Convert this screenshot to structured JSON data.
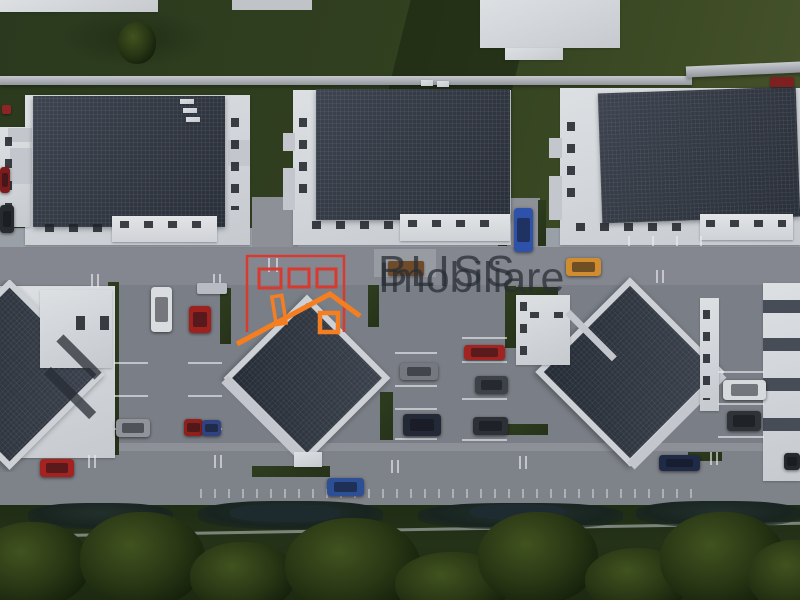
{
  "scene": {
    "type": "aerial-3d-architectural-render",
    "subject": "residential complex with parking lots, three gabled apartment buildings along a street and two diamond-roof buildings below",
    "watermark": {
      "line1": "BLISS",
      "line2": "Imobiliare"
    },
    "logo": {
      "name": "bliss-imobiliare-logo"
    },
    "palette": {
      "wall": "#d2d5da",
      "roof": "#343b45",
      "road": "#84878f",
      "parking": "#7a7e86",
      "sidewalk": "#9aa0a7",
      "lawn": "#2e3c1f",
      "lawn_light": "#46532c",
      "green_bottom": "#223016",
      "hedge": "#182420",
      "logo_red": "#d93a2f",
      "logo_orange": "#f57e20",
      "watermark": "rgba(40,45,52,0.75)",
      "car_glass": "rgba(15,18,24,0.5)"
    },
    "cars": [
      {
        "name": "white-sedan",
        "x": 151,
        "y": 287,
        "w": 21,
        "h": 45,
        "color": "#dadde0"
      },
      {
        "name": "red-hatchback",
        "x": 189,
        "y": 306,
        "w": 22,
        "h": 27,
        "color": "#9e211e"
      },
      {
        "name": "blue-sedan",
        "x": 514,
        "y": 208,
        "w": 19,
        "h": 44,
        "color": "#2e52aa"
      },
      {
        "name": "orange-car",
        "x": 566,
        "y": 258,
        "w": 35,
        "h": 18,
        "color": "#cf8d2f"
      },
      {
        "name": "gray-car",
        "x": 400,
        "y": 363,
        "w": 38,
        "h": 17,
        "color": "#75787f"
      },
      {
        "name": "red-car-middle",
        "x": 464,
        "y": 345,
        "w": 41,
        "h": 15,
        "color": "#a22421"
      },
      {
        "name": "graphite-car",
        "x": 475,
        "y": 376,
        "w": 33,
        "h": 18,
        "color": "#3d4148"
      },
      {
        "name": "dark-car-middle",
        "x": 473,
        "y": 417,
        "w": 35,
        "h": 18,
        "color": "#2d3036"
      },
      {
        "name": "navy-car",
        "x": 403,
        "y": 414,
        "w": 38,
        "h": 22,
        "color": "#242938"
      },
      {
        "name": "white-van",
        "x": 723,
        "y": 380,
        "w": 43,
        "h": 20,
        "color": "#d7dadd"
      },
      {
        "name": "dark-car-right",
        "x": 727,
        "y": 411,
        "w": 34,
        "h": 20,
        "color": "#2f3237"
      },
      {
        "name": "silver-car",
        "x": 116,
        "y": 419,
        "w": 34,
        "h": 18,
        "color": "#90939a"
      },
      {
        "name": "red-car-pair",
        "x": 184,
        "y": 419,
        "w": 19,
        "h": 17,
        "color": "#8f201d"
      },
      {
        "name": "blue-car-pair",
        "x": 202,
        "y": 420,
        "w": 19,
        "h": 16,
        "color": "#30427f"
      },
      {
        "name": "red-car-road",
        "x": 40,
        "y": 459,
        "w": 34,
        "h": 18,
        "color": "#a42320"
      },
      {
        "name": "blue-car-road",
        "x": 327,
        "y": 478,
        "w": 37,
        "h": 18,
        "color": "#2c4f95"
      },
      {
        "name": "navy-car-road",
        "x": 659,
        "y": 455,
        "w": 41,
        "h": 16,
        "color": "#1f2b46"
      },
      {
        "name": "dark-car-corner",
        "x": 784,
        "y": 453,
        "w": 16,
        "h": 17,
        "color": "#25282d"
      },
      {
        "name": "red-car-edge",
        "x": 0,
        "y": 167,
        "w": 10,
        "h": 26,
        "color": "#7d1c1c"
      },
      {
        "name": "dark-car-edge",
        "x": 0,
        "y": 205,
        "w": 14,
        "h": 28,
        "color": "#272a2f"
      }
    ],
    "trees": [
      {
        "name": "tree",
        "x": -25,
        "y": 522,
        "w": 115,
        "h": 85
      },
      {
        "name": "tree",
        "x": 80,
        "y": 512,
        "w": 125,
        "h": 95
      },
      {
        "name": "tree",
        "x": 190,
        "y": 542,
        "w": 105,
        "h": 70
      },
      {
        "name": "tree",
        "x": 285,
        "y": 518,
        "w": 135,
        "h": 95
      },
      {
        "name": "tree",
        "x": 395,
        "y": 552,
        "w": 115,
        "h": 65
      },
      {
        "name": "tree",
        "x": 478,
        "y": 512,
        "w": 120,
        "h": 92
      },
      {
        "name": "tree",
        "x": 585,
        "y": 548,
        "w": 105,
        "h": 65
      },
      {
        "name": "tree",
        "x": 660,
        "y": 512,
        "w": 125,
        "h": 95
      },
      {
        "name": "tree",
        "x": 748,
        "y": 540,
        "w": 95,
        "h": 72
      },
      {
        "name": "lawn-tree",
        "x": 118,
        "y": 22,
        "w": 38,
        "h": 42
      }
    ],
    "hedges": [
      {
        "name": "hedge",
        "x": 28,
        "y": 503,
        "w": 145,
        "h": 26
      },
      {
        "name": "hedge",
        "x": 198,
        "y": 501,
        "w": 185,
        "h": 28
      },
      {
        "name": "hedge",
        "x": 418,
        "y": 503,
        "w": 205,
        "h": 26
      },
      {
        "name": "hedge",
        "x": 636,
        "y": 501,
        "w": 165,
        "h": 26
      },
      {
        "name": "hedge-dark",
        "x": 230,
        "y": 504,
        "w": 110,
        "h": 18,
        "color": "#1d2a2e"
      },
      {
        "name": "hedge-dark",
        "x": 470,
        "y": 504,
        "w": 95,
        "h": 16,
        "color": "#1e2b30"
      }
    ],
    "props": [
      {
        "name": "wooden-bench",
        "x": 388,
        "y": 261,
        "w": 36,
        "h": 15,
        "color": "#6f4b29"
      },
      {
        "name": "stone-bench",
        "x": 197,
        "y": 283,
        "w": 30,
        "h": 11,
        "color": "#b8bbc1"
      },
      {
        "name": "flower-patch-right",
        "x": 770,
        "y": 77,
        "w": 24,
        "h": 10,
        "color": "#7e2020"
      },
      {
        "name": "flower-patch-left",
        "x": 2,
        "y": 105,
        "w": 9,
        "h": 9,
        "color": "#8e2424"
      }
    ],
    "parking_lines": {
      "h": [
        {
          "x": 114,
          "y": 362,
          "w": 34,
          "h": 2
        },
        {
          "x": 114,
          "y": 395,
          "w": 34,
          "h": 2
        },
        {
          "x": 114,
          "y": 428,
          "w": 34,
          "h": 2
        },
        {
          "x": 188,
          "y": 362,
          "w": 34,
          "h": 2
        },
        {
          "x": 188,
          "y": 395,
          "w": 34,
          "h": 2
        },
        {
          "x": 188,
          "y": 428,
          "w": 34,
          "h": 2
        },
        {
          "x": 395,
          "y": 352,
          "w": 42,
          "h": 2
        },
        {
          "x": 395,
          "y": 385,
          "w": 42,
          "h": 2
        },
        {
          "x": 395,
          "y": 408,
          "w": 42,
          "h": 2
        },
        {
          "x": 395,
          "y": 438,
          "w": 42,
          "h": 2
        },
        {
          "x": 462,
          "y": 337,
          "w": 45,
          "h": 2
        },
        {
          "x": 462,
          "y": 361,
          "w": 45,
          "h": 2
        },
        {
          "x": 462,
          "y": 398,
          "w": 45,
          "h": 2
        },
        {
          "x": 462,
          "y": 439,
          "w": 45,
          "h": 2
        },
        {
          "x": 718,
          "y": 371,
          "w": 46,
          "h": 2
        },
        {
          "x": 718,
          "y": 403,
          "w": 46,
          "h": 2
        },
        {
          "x": 718,
          "y": 436,
          "w": 46,
          "h": 2
        }
      ],
      "v": [
        {
          "x": 91,
          "y": 274,
          "w": 2,
          "h": 13
        },
        {
          "x": 97,
          "y": 274,
          "w": 2,
          "h": 13
        },
        {
          "x": 213,
          "y": 274,
          "w": 2,
          "h": 13
        },
        {
          "x": 219,
          "y": 274,
          "w": 2,
          "h": 13
        },
        {
          "x": 656,
          "y": 270,
          "w": 2,
          "h": 13
        },
        {
          "x": 662,
          "y": 270,
          "w": 2,
          "h": 13
        },
        {
          "x": 268,
          "y": 258,
          "w": 2,
          "h": 14
        },
        {
          "x": 276,
          "y": 258,
          "w": 2,
          "h": 14
        },
        {
          "x": 88,
          "y": 455,
          "w": 2,
          "h": 13
        },
        {
          "x": 94,
          "y": 455,
          "w": 2,
          "h": 13
        },
        {
          "x": 214,
          "y": 455,
          "w": 2,
          "h": 13
        },
        {
          "x": 220,
          "y": 455,
          "w": 2,
          "h": 13
        },
        {
          "x": 391,
          "y": 460,
          "w": 2,
          "h": 13
        },
        {
          "x": 397,
          "y": 460,
          "w": 2,
          "h": 13
        },
        {
          "x": 519,
          "y": 456,
          "w": 2,
          "h": 13
        },
        {
          "x": 525,
          "y": 456,
          "w": 2,
          "h": 13
        },
        {
          "x": 710,
          "y": 452,
          "w": 2,
          "h": 13
        },
        {
          "x": 716,
          "y": 452,
          "w": 2,
          "h": 13
        },
        {
          "x": 628,
          "y": 236,
          "w": 2,
          "h": 10
        },
        {
          "x": 652,
          "y": 236,
          "w": 2,
          "h": 10
        },
        {
          "x": 676,
          "y": 236,
          "w": 2,
          "h": 10
        },
        {
          "x": 700,
          "y": 236,
          "w": 2,
          "h": 10
        }
      ]
    }
  }
}
